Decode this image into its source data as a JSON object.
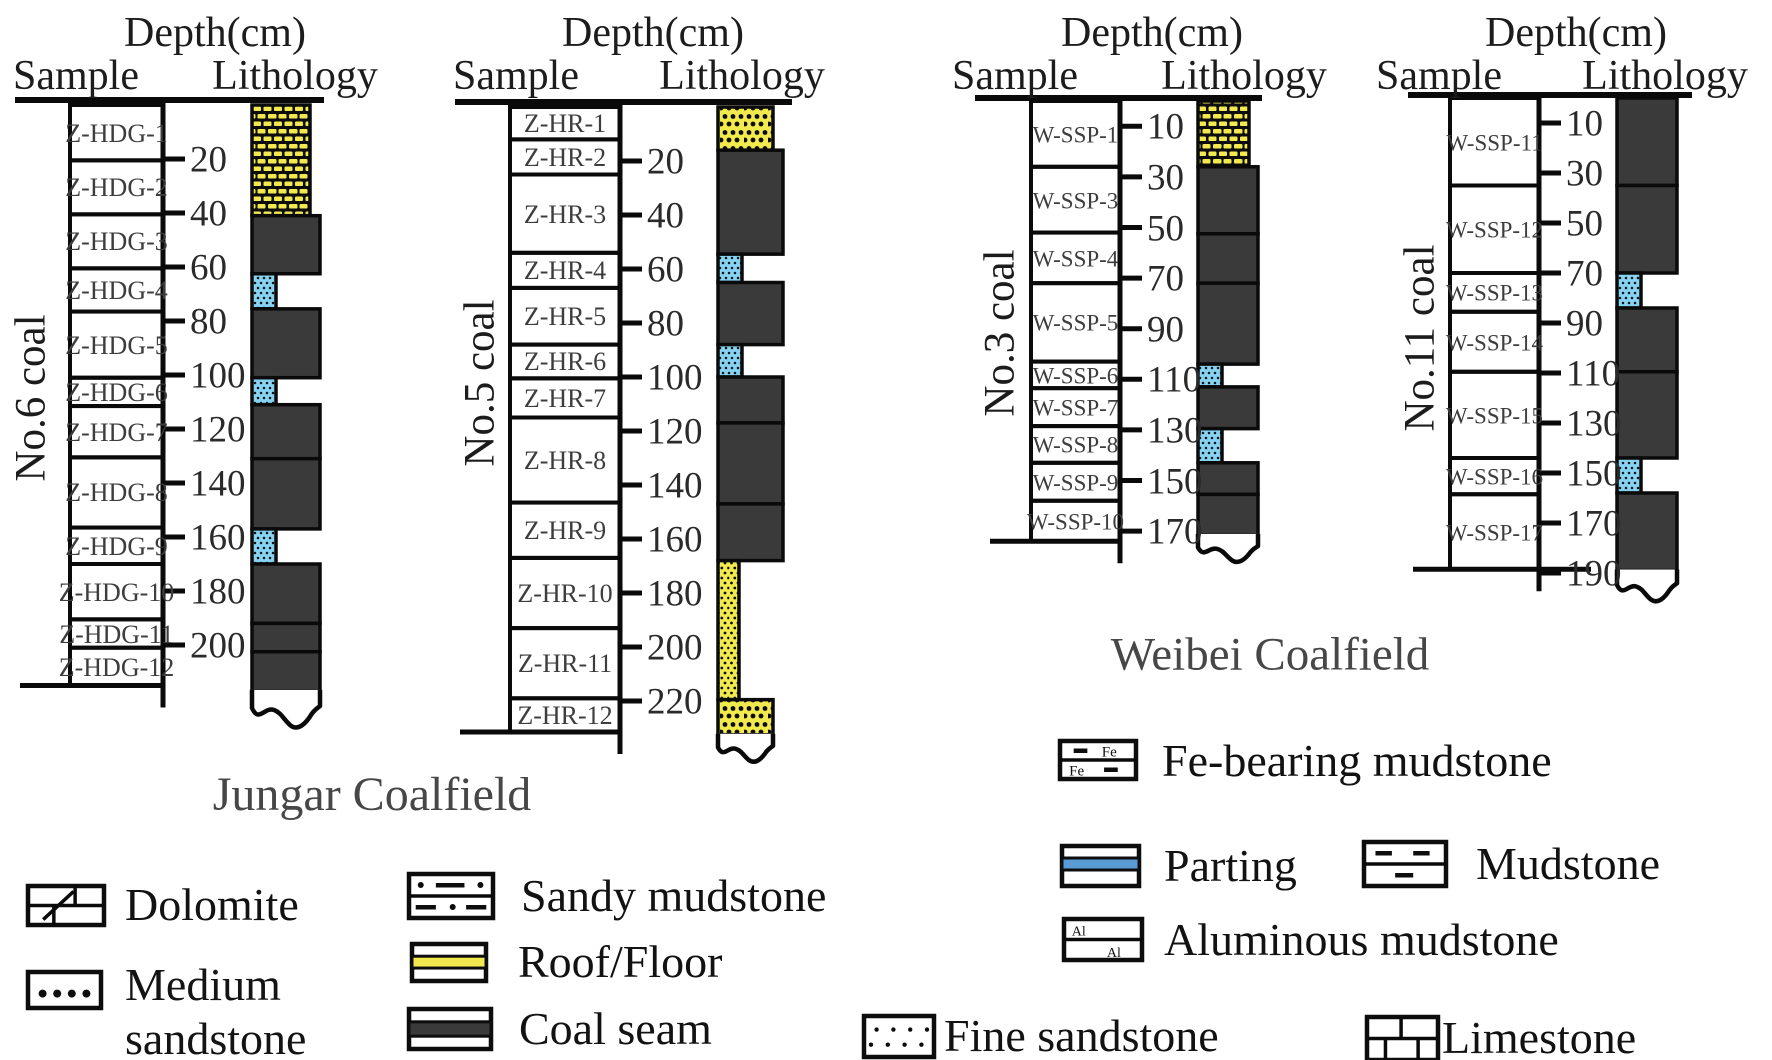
{
  "figure": {
    "captions": {
      "jungar": "Jungar Coalfield",
      "weibei": "Weibei Coalfield"
    },
    "column_headers": {
      "depth": "Depth(cm)",
      "sample": "Sample",
      "lithology": "Lithology"
    }
  },
  "colors": {
    "coal": "#3a3a3a",
    "roof_yellow": "#f2e94e",
    "parting_blue": "#85d2f3",
    "legend_parting_blue": "#5b9bd5",
    "line_black": "#0a0a0a",
    "text_dark": "#1c1c1c",
    "text_gray": "#474747"
  },
  "columns": [
    {
      "id": "no6",
      "label": "No.6 coal",
      "coalfield": "Jungar",
      "ticks": [
        20,
        40,
        60,
        80,
        100,
        120,
        140,
        160,
        180,
        200
      ],
      "samples": [
        {
          "label": "Z-HDG-1",
          "top": 0,
          "bottom": 20.5
        },
        {
          "label": "Z-HDG-2",
          "top": 20.5,
          "bottom": 40.5
        },
        {
          "label": "Z-HDG-3",
          "top": 40.5,
          "bottom": 60.5
        },
        {
          "label": "Z-HDG-4",
          "top": 60.5,
          "bottom": 76.5
        },
        {
          "label": "Z-HDG-5",
          "top": 76.5,
          "bottom": 101
        },
        {
          "label": "Z-HDG-6",
          "top": 101,
          "bottom": 111.5
        },
        {
          "label": "Z-HDG-7",
          "top": 111.5,
          "bottom": 130.5
        },
        {
          "label": "Z-HDG-8",
          "top": 130.5,
          "bottom": 156.5
        },
        {
          "label": "Z-HDG-9",
          "top": 156.5,
          "bottom": 170
        },
        {
          "label": "Z-HDG-10",
          "top": 170,
          "bottom": 190.5
        },
        {
          "label": "Z-HDG-11",
          "top": 190.5,
          "bottom": 201
        },
        {
          "label": "Z-HDG-12",
          "top": 201,
          "bottom": 215
        }
      ],
      "lithology": [
        {
          "type": "dolomite",
          "top": 0,
          "bottom": 41,
          "w": "med"
        },
        {
          "type": "coal",
          "top": 41,
          "bottom": 62.5,
          "w": "full"
        },
        {
          "type": "parting",
          "top": 62.5,
          "bottom": 75.5,
          "w": "narrow"
        },
        {
          "type": "coal",
          "top": 75.5,
          "bottom": 101,
          "w": "full"
        },
        {
          "type": "parting",
          "top": 101,
          "bottom": 111,
          "w": "narrow"
        },
        {
          "type": "coal",
          "top": 111,
          "bottom": 131,
          "w": "full"
        },
        {
          "type": "coal",
          "top": 131,
          "bottom": 157,
          "w": "full"
        },
        {
          "type": "parting",
          "top": 157,
          "bottom": 170,
          "w": "narrow"
        },
        {
          "type": "coal",
          "top": 170,
          "bottom": 192,
          "w": "full"
        },
        {
          "type": "coal",
          "top": 192,
          "bottom": 202.5,
          "w": "full"
        },
        {
          "type": "coal",
          "top": 202.5,
          "bottom": 217,
          "w": "full"
        }
      ],
      "base_depth": 215
    },
    {
      "id": "no5",
      "label": "No.5 coal",
      "coalfield": "Jungar",
      "ticks": [
        20,
        40,
        60,
        80,
        100,
        120,
        140,
        160,
        180,
        200,
        220
      ],
      "samples": [
        {
          "label": "Z-HR-1",
          "top": 0,
          "bottom": 12
        },
        {
          "label": "Z-HR-2",
          "top": 12,
          "bottom": 25
        },
        {
          "label": "Z-HR-3",
          "top": 25,
          "bottom": 54
        },
        {
          "label": "Z-HR-4",
          "top": 54,
          "bottom": 67
        },
        {
          "label": "Z-HR-5",
          "top": 67,
          "bottom": 88
        },
        {
          "label": "Z-HR-6",
          "top": 88,
          "bottom": 100.5
        },
        {
          "label": "Z-HR-7",
          "top": 100.5,
          "bottom": 115
        },
        {
          "label": "Z-HR-8",
          "top": 115,
          "bottom": 146.5
        },
        {
          "label": "Z-HR-9",
          "top": 146.5,
          "bottom": 167
        },
        {
          "label": "Z-HR-10",
          "top": 167,
          "bottom": 193
        },
        {
          "label": "Z-HR-11",
          "top": 193,
          "bottom": 219
        },
        {
          "label": "Z-HR-12",
          "top": 219,
          "bottom": 231.5
        }
      ],
      "lithology": [
        {
          "type": "medium_sandstone",
          "top": 0,
          "bottom": 16,
          "w": "med"
        },
        {
          "type": "coal",
          "top": 16,
          "bottom": 54.5,
          "w": "full"
        },
        {
          "type": "parting",
          "top": 54.5,
          "bottom": 65,
          "w": "narrow"
        },
        {
          "type": "coal",
          "top": 65,
          "bottom": 88,
          "w": "full"
        },
        {
          "type": "parting",
          "top": 88,
          "bottom": 100,
          "w": "narrow"
        },
        {
          "type": "coal",
          "top": 100,
          "bottom": 117,
          "w": "full"
        },
        {
          "type": "coal",
          "top": 117,
          "bottom": 147,
          "w": "full"
        },
        {
          "type": "coal",
          "top": 147,
          "bottom": 168,
          "w": "full"
        },
        {
          "type": "fine_sandstone",
          "top": 168,
          "bottom": 219.5,
          "w": "fine"
        },
        {
          "type": "medium_sandstone",
          "top": 219.5,
          "bottom": 232.5,
          "w": "med"
        }
      ],
      "base_depth": 231.5
    },
    {
      "id": "no3",
      "label": "No.3 coal",
      "coalfield": "Weibei",
      "ticks": [
        10,
        30,
        50,
        70,
        90,
        110,
        130,
        150,
        170
      ],
      "samples": [
        {
          "label": "W-SSP-1",
          "top": 0,
          "bottom": 26
        },
        {
          "label": "W-SSP-3",
          "top": 26,
          "bottom": 52
        },
        {
          "label": "W-SSP-4",
          "top": 52,
          "bottom": 72
        },
        {
          "label": "W-SSP-5",
          "top": 72,
          "bottom": 103
        },
        {
          "label": "W-SSP-6",
          "top": 103,
          "bottom": 113.5
        },
        {
          "label": "W-SSP-7",
          "top": 113.5,
          "bottom": 128.5
        },
        {
          "label": "W-SSP-8",
          "top": 128.5,
          "bottom": 143
        },
        {
          "label": "W-SSP-9",
          "top": 143,
          "bottom": 158
        },
        {
          "label": "W-SSP-10",
          "top": 158,
          "bottom": 174
        }
      ],
      "lithology": [
        {
          "type": "dolomite",
          "top": 0,
          "bottom": 26,
          "w": "med"
        },
        {
          "type": "coal",
          "top": 26,
          "bottom": 52.5,
          "w": "full"
        },
        {
          "type": "coal",
          "top": 52.5,
          "bottom": 72,
          "w": "full"
        },
        {
          "type": "coal",
          "top": 72,
          "bottom": 104,
          "w": "full"
        },
        {
          "type": "parting",
          "top": 104,
          "bottom": 113,
          "w": "narrow"
        },
        {
          "type": "coal",
          "top": 113,
          "bottom": 129.5,
          "w": "full"
        },
        {
          "type": "parting",
          "top": 129.5,
          "bottom": 143,
          "w": "narrow"
        },
        {
          "type": "coal",
          "top": 143,
          "bottom": 155.5,
          "w": "full"
        },
        {
          "type": "coal",
          "top": 155.5,
          "bottom": 171.5,
          "w": "full"
        }
      ],
      "base_depth": 174
    },
    {
      "id": "no11",
      "label": "No.11 coal",
      "coalfield": "Weibei",
      "ticks": [
        10,
        30,
        50,
        70,
        90,
        110,
        130,
        150,
        170,
        190
      ],
      "samples": [
        {
          "label": "W-SSP-11",
          "top": 0,
          "bottom": 35
        },
        {
          "label": "W-SSP-12",
          "top": 35,
          "bottom": 70
        },
        {
          "label": "W-SSP-13",
          "top": 70,
          "bottom": 85.5
        },
        {
          "label": "W-SSP-14",
          "top": 85.5,
          "bottom": 109.5
        },
        {
          "label": "W-SSP-15",
          "top": 109.5,
          "bottom": 144
        },
        {
          "label": "W-SSP-16",
          "top": 144,
          "bottom": 158.5
        },
        {
          "label": "W-SSP-17",
          "top": 158.5,
          "bottom": 188.5
        }
      ],
      "lithology": [
        {
          "type": "coal",
          "top": 0,
          "bottom": 35,
          "w": "full"
        },
        {
          "type": "coal",
          "top": 35,
          "bottom": 70,
          "w": "full"
        },
        {
          "type": "parting",
          "top": 70,
          "bottom": 84,
          "w": "narrow"
        },
        {
          "type": "coal",
          "top": 84,
          "bottom": 109.5,
          "w": "full"
        },
        {
          "type": "coal",
          "top": 109.5,
          "bottom": 144,
          "w": "full"
        },
        {
          "type": "parting",
          "top": 144,
          "bottom": 158,
          "w": "narrow"
        },
        {
          "type": "coal",
          "top": 158,
          "bottom": 189,
          "w": "full"
        }
      ],
      "base_depth": 188.5
    }
  ],
  "legend": {
    "items": [
      {
        "pattern": "dolomite",
        "label": "Dolomite"
      },
      {
        "pattern": "medium_sandstone",
        "label": "Medium sandstone"
      },
      {
        "pattern": "sandy_mudstone",
        "label": "Sandy mudstone"
      },
      {
        "pattern": "roof_floor",
        "label": "Roof/Floor"
      },
      {
        "pattern": "coal_seam",
        "label": "Coal seam"
      },
      {
        "pattern": "fe_bearing",
        "label": "Fe-bearing mudstone",
        "inner_texts": [
          "Fe",
          "Fe"
        ]
      },
      {
        "pattern": "parting",
        "label": "Parting"
      },
      {
        "pattern": "mudstone",
        "label": "Mudstone"
      },
      {
        "pattern": "aluminous",
        "label": "Aluminous mudstone",
        "inner_texts": [
          "Al",
          "Al"
        ]
      },
      {
        "pattern": "fine_sandstone",
        "label": "Fine sandstone"
      },
      {
        "pattern": "limestone",
        "label": "Limestone"
      }
    ]
  }
}
